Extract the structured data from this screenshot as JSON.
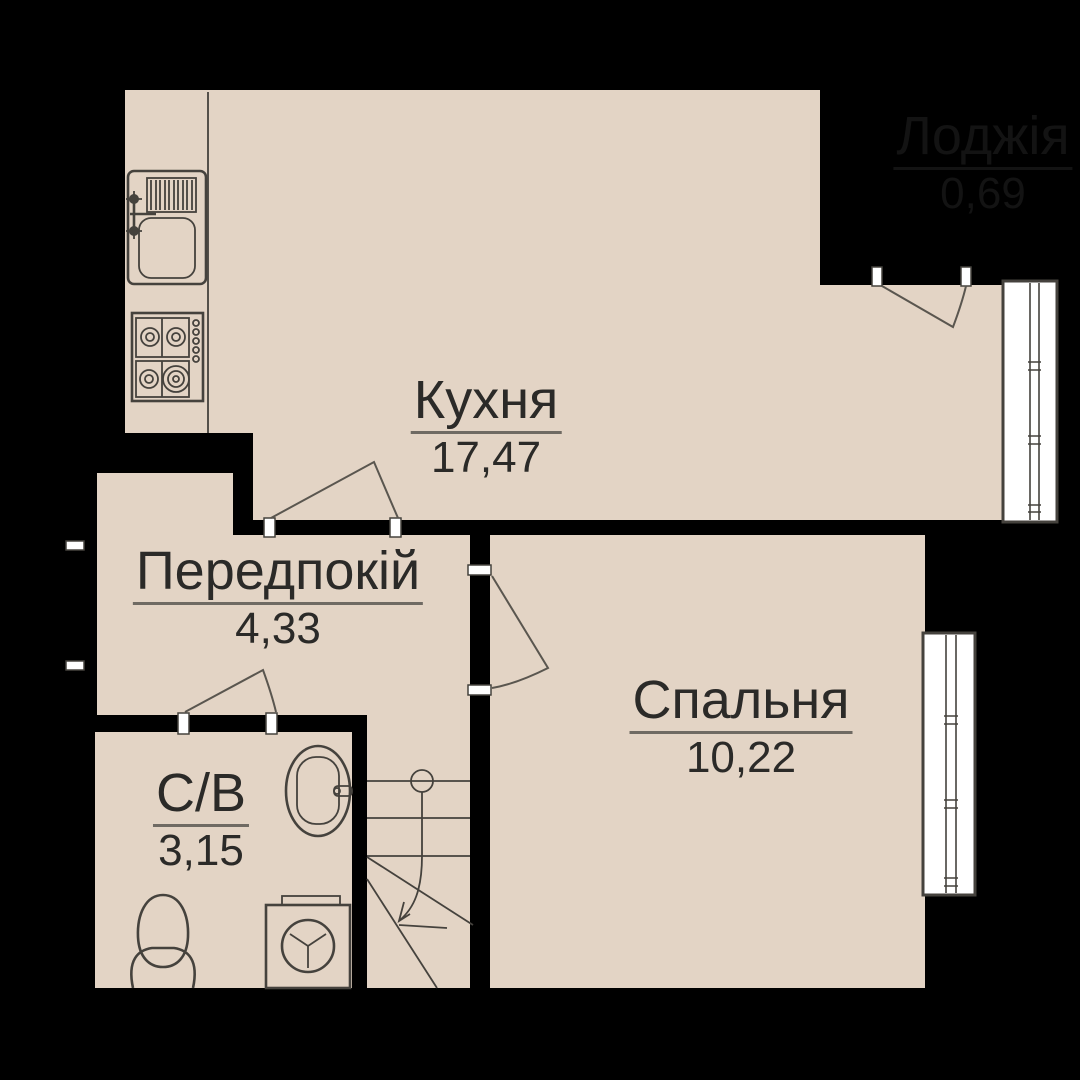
{
  "colors": {
    "background": "#000000",
    "floor": "#e3d4c5",
    "window": "#ffffff",
    "outline": "#45423d",
    "door_swing": "#5a564f",
    "label_text": "#2b2a28",
    "label_underline": "#6f6a63",
    "excluded_area_text": "#131313"
  },
  "rooms": [
    {
      "id": "kitchen",
      "name": "Кухня",
      "area": "17,47"
    },
    {
      "id": "hallway",
      "name": "Передпокій",
      "area": "4,33"
    },
    {
      "id": "bedroom",
      "name": "Спальня",
      "area": "10,22"
    },
    {
      "id": "bathroom",
      "name": "С/В",
      "area": "3,15"
    },
    {
      "id": "loggia",
      "name": "Лоджія",
      "area": "0,69",
      "excluded": true
    }
  ],
  "fixtures": [
    "kitchen-sink",
    "stove",
    "bathroom-washbasin",
    "toilet",
    "washing-machine",
    "staircase",
    "kitchen-window",
    "bedroom-window",
    "balcony-door",
    "kitchen-door",
    "bathroom-door",
    "bedroom-door",
    "entrance-opening"
  ]
}
